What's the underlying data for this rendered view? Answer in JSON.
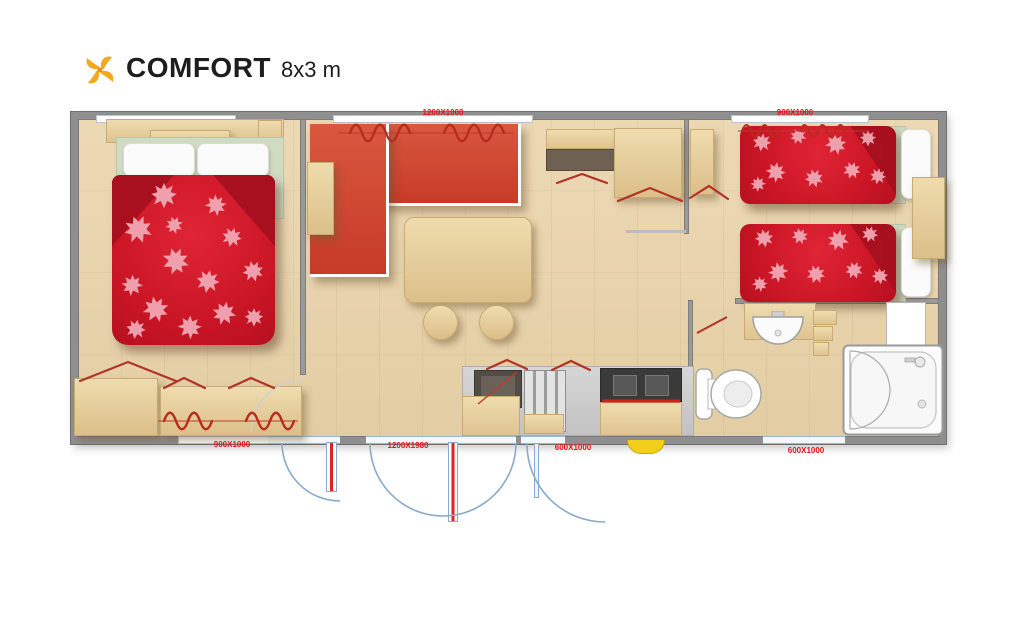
{
  "header": {
    "title": "COMFORT",
    "subtitle": "8x3 m",
    "logo_icon": "pinwheel-icon"
  },
  "floorplan": {
    "dimension_labels": {
      "top_center": "1200X1000",
      "top_right": "900X1000",
      "bottom_left": "900X1000",
      "bottom_center": "1200X1980",
      "bottom_kitchen": "600X1000",
      "bottom_right": "600X1000"
    },
    "colors": {
      "bedding_red": "#cb1626",
      "bedding_fold_red": "#a50f1e",
      "leaf_pink": "#f2abb7",
      "sofa_red": "#d2452f",
      "floor_wood": "#e8d4ae",
      "furniture_wood": "#e9d3a4",
      "wall_grey": "#8f8f8f",
      "dimension_label_red": "#e8111a",
      "door_arc_blue": "#8aa9cc",
      "radiator_red": "#b92b1d",
      "sheet_green": "#cfdcc2",
      "gas_yellow": "#f2cf1b",
      "logo_orange": "#f5a71f"
    }
  }
}
